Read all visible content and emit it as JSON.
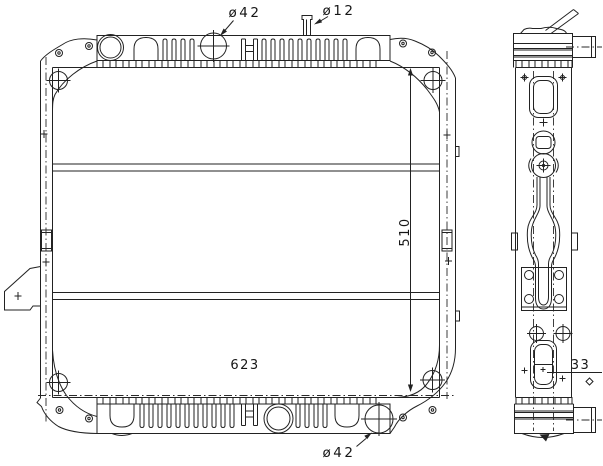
{
  "drawing": {
    "description_labels": {
      "front_view": "radiator front view",
      "side_view": "radiator side view"
    }
  },
  "dimensions": {
    "top_filler_diameter": "ø42",
    "overflow_pipe_diameter": "ø12",
    "core_height": "510",
    "core_width": "623",
    "bottom_outlet_diameter": "ø42",
    "frame_depth": "33"
  },
  "colors": {
    "line": "#222222",
    "background": "#ffffff"
  }
}
